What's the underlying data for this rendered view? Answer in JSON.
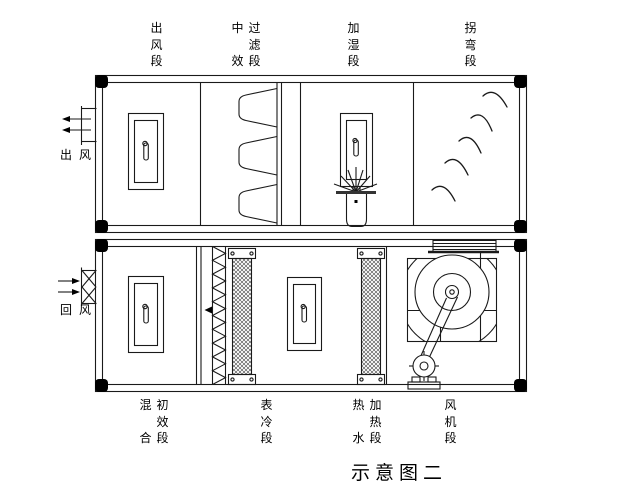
{
  "caption": "示意图二",
  "line_color": "#1a1a1a",
  "labels": {
    "top": [
      {
        "name": "air-outlet-section",
        "cols": [
          "出风段"
        ]
      },
      {
        "name": "medium-filter-section",
        "cols": [
          "中效",
          "过滤段"
        ]
      },
      {
        "name": "humidifier-section",
        "cols": [
          "加湿段"
        ]
      },
      {
        "name": "turn-section",
        "cols": [
          "拐弯段"
        ]
      }
    ],
    "bottom": [
      {
        "name": "mixing-prefilter-section",
        "cols": [
          "混合",
          "初效段"
        ]
      },
      {
        "name": "cooling-coil-section",
        "cols": [
          "表冷段"
        ]
      },
      {
        "name": "hot-water-heating-section",
        "cols": [
          "热水",
          "加热段"
        ]
      },
      {
        "name": "fan-section",
        "cols": [
          "风机段"
        ]
      }
    ],
    "left_top": "出风",
    "left_bottom": "回风"
  }
}
